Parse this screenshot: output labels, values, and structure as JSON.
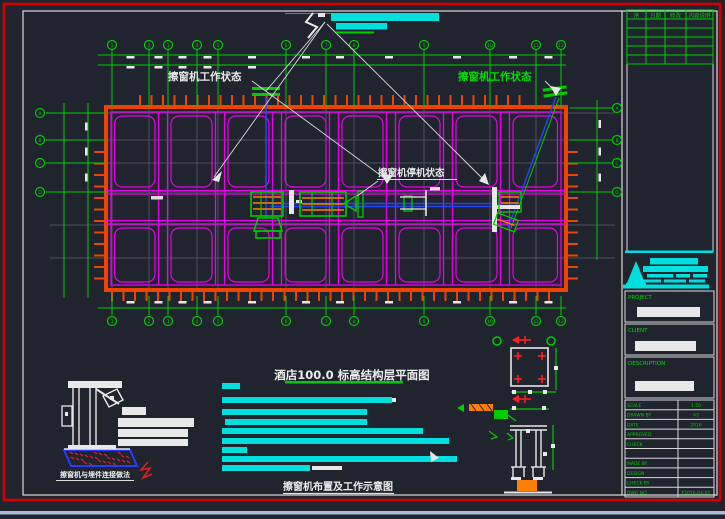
{
  "labels": {
    "working_state_left": "擦窗机工作状态",
    "working_state_right": "擦窗机工作状态",
    "parked_state": "擦窗机停机状态",
    "plan_title": "酒店100.0 标高结构层平面图",
    "figure_title": "擦窗机布置及工作示意图",
    "detail_title": "擦窗机与埋件连接做法",
    "notes_heading": "说明:"
  },
  "title_block": {
    "project_label": "PROJECT",
    "client_label": "CLIENT",
    "description_label": "DESCRIPTION",
    "revision_header": [
      "序",
      "日期",
      "修改",
      "内容说明"
    ],
    "rows": [
      {
        "label": "SCALE",
        "value": "1:50"
      },
      {
        "label": "DRAWN BY",
        "value": "A2"
      },
      {
        "label": "DATE",
        "value": "2016"
      },
      {
        "label": "APPROVED",
        "value": ""
      },
      {
        "label": "CHECK",
        "value": ""
      },
      {
        "label": "",
        "value": ""
      },
      {
        "label": "MADE BY",
        "value": ""
      },
      {
        "label": "DESIGN",
        "value": ""
      },
      {
        "label": "CHECK BY",
        "value": ""
      },
      {
        "label": "DWG NO",
        "value": "F2016-04-01"
      }
    ]
  },
  "grid": {
    "top_x": [
      112,
      149,
      168,
      197,
      218,
      286,
      326,
      354,
      424,
      490,
      536,
      561
    ],
    "top_labels": [
      "1",
      "2",
      "3",
      "4",
      "5",
      "6",
      "7",
      "8",
      "9",
      "10",
      "11",
      "12"
    ],
    "left_y": [
      113,
      140,
      163,
      192
    ],
    "left_labels": [
      "A",
      "B",
      "C",
      "D"
    ],
    "right_y": [
      108,
      140,
      163,
      192
    ],
    "right_labels": [
      "A",
      "B",
      "C",
      "D"
    ]
  },
  "plan": {
    "wall": {
      "x": 106,
      "y": 107,
      "w": 460,
      "h": 183
    },
    "wall_x_doubles": [
      163,
      220,
      277,
      334,
      391,
      448,
      505
    ],
    "bay_top": {
      "y": 116,
      "h": 71
    },
    "bay_bottom": {
      "y": 228,
      "h": 54
    }
  },
  "notes_bars": [
    {
      "x": 222,
      "y": 383,
      "w": 18
    },
    {
      "x": 222,
      "y": 397,
      "w": 170
    },
    {
      "x": 222,
      "y": 409,
      "w": 145
    },
    {
      "x": 225,
      "y": 419,
      "w": 142
    },
    {
      "x": 222,
      "y": 428,
      "w": 201
    },
    {
      "x": 222,
      "y": 438,
      "w": 227
    },
    {
      "x": 222,
      "y": 447,
      "w": 25
    },
    {
      "x": 222,
      "y": 456,
      "w": 235
    },
    {
      "x": 222,
      "y": 465,
      "w": 88
    }
  ],
  "colors": {
    "background": "#20242e",
    "frame_red": "#d40000",
    "frame_white": "#dcdcdc",
    "green": "#00cc00",
    "magenta": "#e800e8",
    "wall_orange": "#ef4300",
    "cyan": "#00dede",
    "blue": "#2543f0",
    "gray_grid": "#4c515c",
    "hatch_orange": "#ff8000",
    "red_mark": "#e02020",
    "bottom_strip": "#a9bdd8"
  }
}
